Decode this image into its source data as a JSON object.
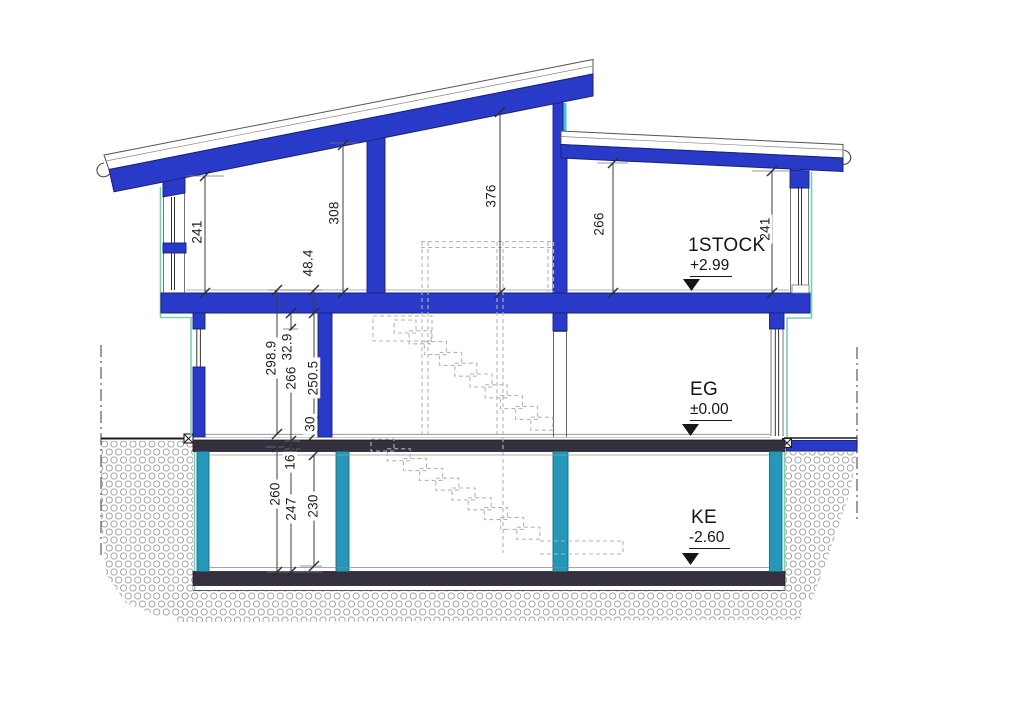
{
  "levels": [
    {
      "name": "1STOCK",
      "elevation": "+2.99"
    },
    {
      "name": "EG",
      "elevation": "±0.00"
    },
    {
      "name": "KE",
      "elevation": "-2.60"
    }
  ],
  "dimensions": {
    "upper_left_height": "241",
    "upper_mid_left_height": "308",
    "upper_mid_height": "376",
    "upper_right_height": "266",
    "upper_right_wall_height": "241",
    "floor_buildup_upper": "48.4",
    "slab_thickness": "32.9",
    "eg_floor_to_floor": "298.9",
    "eg_raw_height": "266",
    "eg_clear_height": "250.5",
    "eg_screed": "30",
    "ke_slab": "16",
    "ke_raw_height": "260",
    "ke_clear_height": "247",
    "ke_inner_height": "230"
  },
  "colors": {
    "structure_blue": "#2a3ac8",
    "basement_teal": "#2697b8",
    "slab_dark": "#362f3d",
    "envelope_green": "#72d2b4",
    "glass_cyan": "#3fc3d4",
    "ground_hatch": "#9b9b9b"
  }
}
